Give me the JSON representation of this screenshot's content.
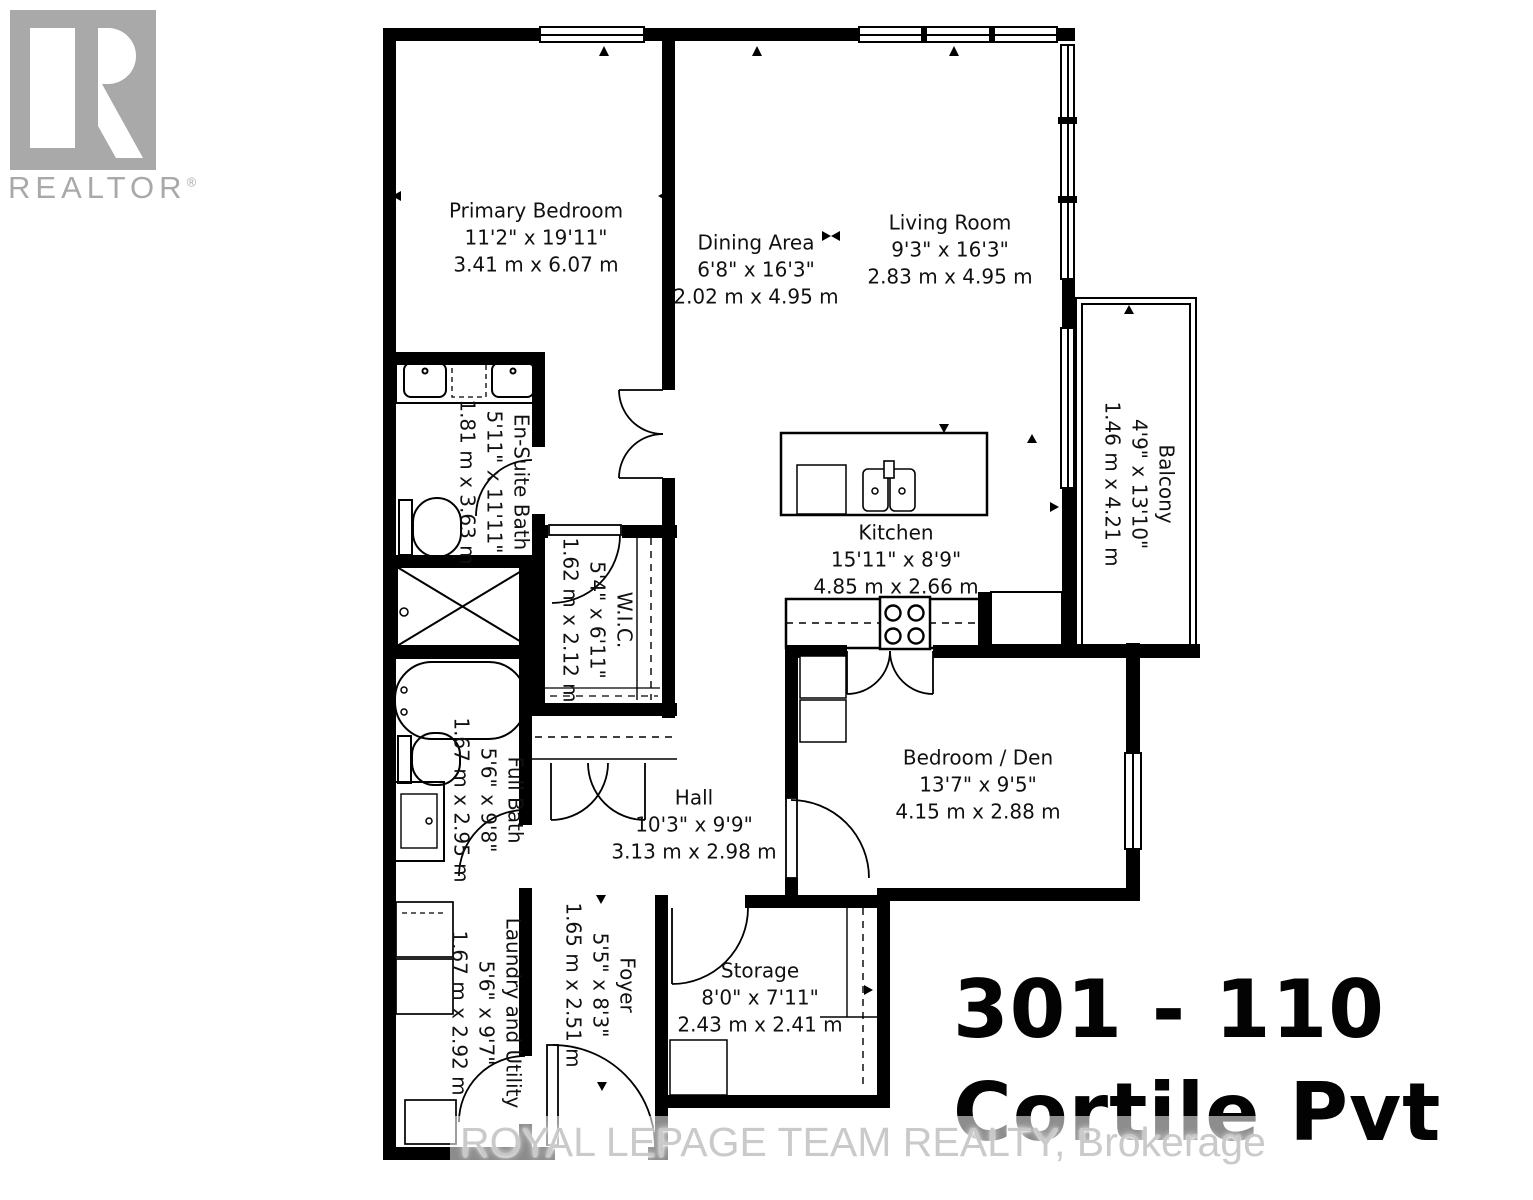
{
  "logo": {
    "brand": "REALTOR",
    "registered": "®"
  },
  "rooms": {
    "primary_bedroom": {
      "name": "Primary Bedroom",
      "imperial": "11'2\" x 19'11\"",
      "metric": "3.41 m x 6.07 m"
    },
    "dining_area": {
      "name": "Dining Area",
      "imperial": "6'8\" x 16'3\"",
      "metric": "2.02 m x 4.95 m"
    },
    "living_room": {
      "name": "Living Room",
      "imperial": "9'3\" x 16'3\"",
      "metric": "2.83 m x 4.95 m"
    },
    "balcony": {
      "name": "Balcony",
      "imperial": "4'9\" x 13'10\"",
      "metric": "1.46 m x 4.21 m"
    },
    "ensuite_bath": {
      "name": "En-Suite Bath",
      "imperial": "5'11\" x 11'11\"",
      "metric": "1.81 m x 3.63 m"
    },
    "wic": {
      "name": "W.I.C.",
      "imperial": "5'4\" x 6'11\"",
      "metric": "1.62 m x 2.12 m"
    },
    "kitchen": {
      "name": "Kitchen",
      "imperial": "15'11\" x 8'9\"",
      "metric": "4.85 m x 2.66 m"
    },
    "full_bath": {
      "name": "Full Bath",
      "imperial": "5'6\" x 9'8\"",
      "metric": "1.67 m x 2.95 m"
    },
    "hall": {
      "name": "Hall",
      "imperial": "10'3\" x 9'9\"",
      "metric": "3.13 m x 2.98 m"
    },
    "bedroom_den": {
      "name": "Bedroom / Den",
      "imperial": "13'7\" x 9'5\"",
      "metric": "4.15 m x 2.88 m"
    },
    "laundry": {
      "name": "Laundry and Utility",
      "imperial": "5'6\" x 9'7\"",
      "metric": "1.67 m x 2.92 m"
    },
    "foyer": {
      "name": "Foyer",
      "imperial": "5'5\" x 8'3\"",
      "metric": "1.65 m x 2.51 m"
    },
    "storage": {
      "name": "Storage",
      "imperial": "8'0\" x 7'11\"",
      "metric": "2.43 m x 2.41 m"
    }
  },
  "address": {
    "line1": "301 - 110",
    "line2": "Cortile Pvt"
  },
  "watermark": "ROYAL LEPAGE TEAM REALTY, Brokerage",
  "colors": {
    "wall": "#000000",
    "logo_gray": "#a9a9a9",
    "watermark_gray": "#c5c5c5"
  }
}
